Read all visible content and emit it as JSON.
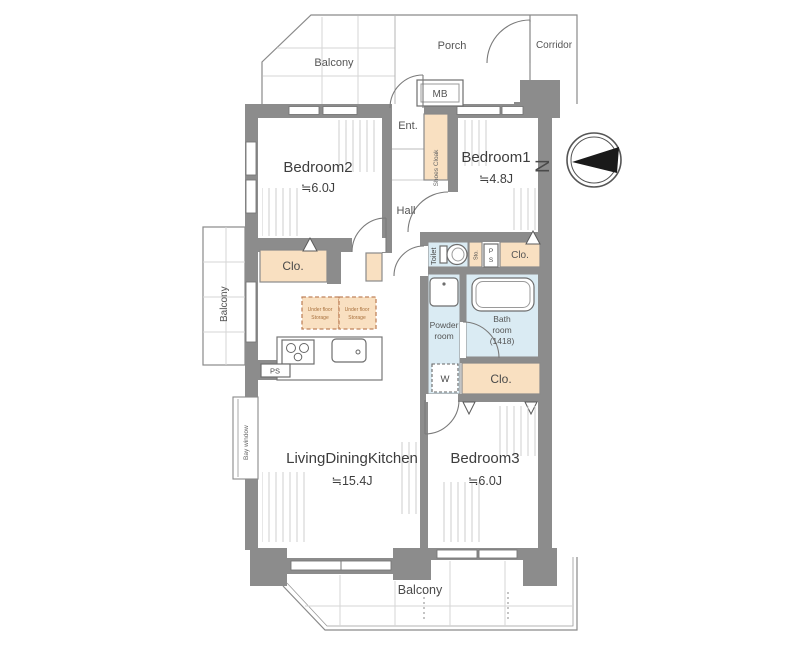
{
  "colors": {
    "wall": "#8c8c8c",
    "closet_fill": "#f9e0c1",
    "wet_area_fill": "#daebf3",
    "outline": "#7a7a7a",
    "under_floor_dash": "#c0845c"
  },
  "plan": {
    "outdoor": {
      "balcony_top": "Balcony",
      "porch": "Porch",
      "corridor": "Corridor",
      "meter_box": "MB",
      "balcony_left": "Balcony",
      "bay_window": "Bay window",
      "balcony_bottom": "Balcony"
    },
    "entrance": {
      "ent": "Ent.",
      "shoes_cloak": "Shoes Cloak",
      "hall": "Hall"
    },
    "rooms": {
      "bedroom1": {
        "name": "Bedroom1",
        "size": "≒4.8J"
      },
      "bedroom2": {
        "name": "Bedroom2",
        "size": "≒6.0J"
      },
      "bedroom3": {
        "name": "Bedroom3",
        "size": "≒6.0J"
      },
      "ldk": {
        "name": "LivingDiningKitchen",
        "size": "≒15.4J"
      },
      "toilet": "Toilet",
      "powder": {
        "line1": "Powder",
        "line2": "room"
      },
      "bath": {
        "line1": "Bath",
        "line2": "room",
        "line3": "(1418)"
      }
    },
    "storage": {
      "closet": "Clo.",
      "sto": "Sto.",
      "w": "W",
      "under_floor": {
        "line1": "Under floor",
        "line2": "Storage"
      },
      "ps_vertical": {
        "p": "P",
        "s": "S"
      },
      "ps_kitchen": "PS"
    },
    "compass": {
      "north": "N"
    }
  }
}
